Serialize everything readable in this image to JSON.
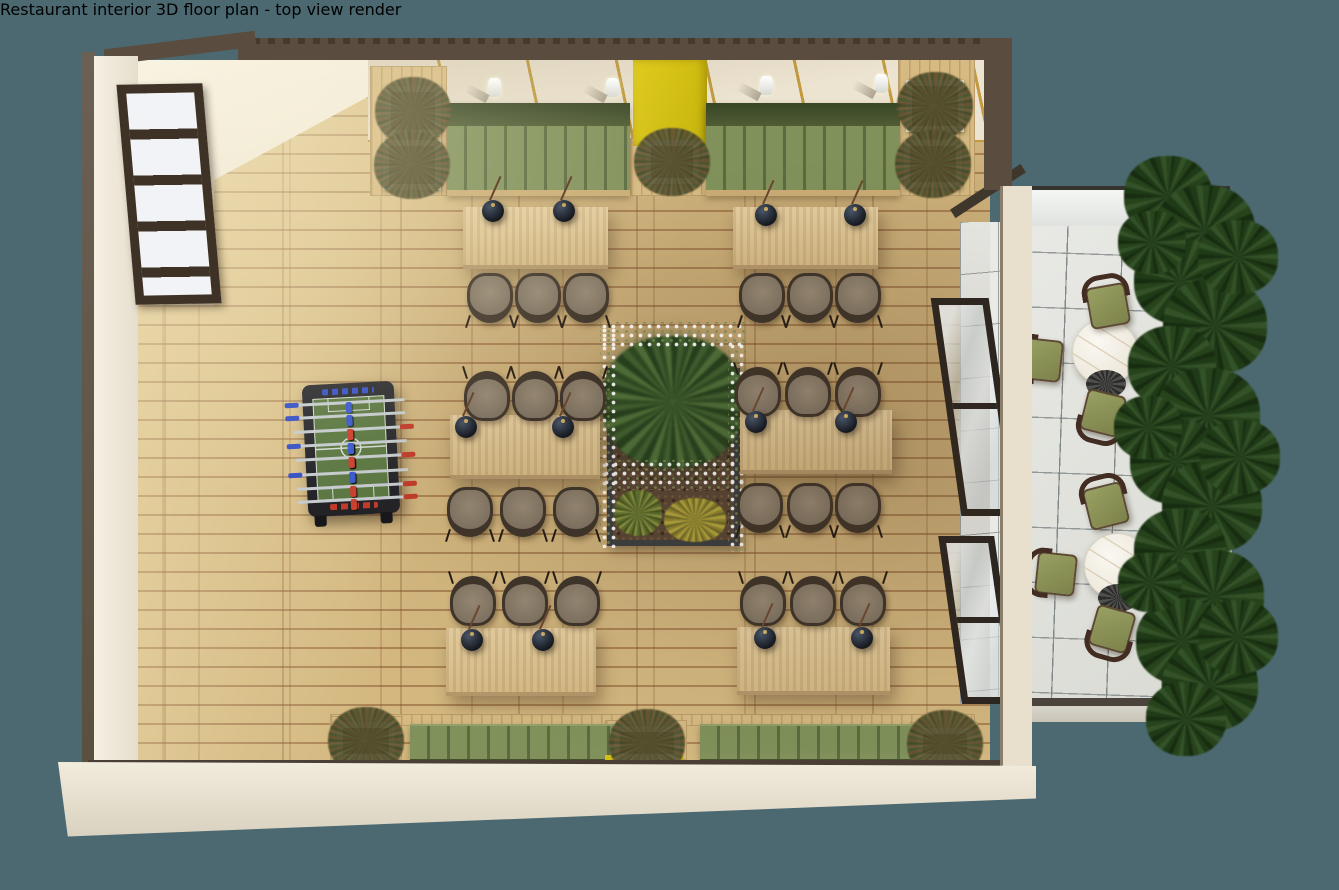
{
  "scene": {
    "title": "Restaurant interior 3D floor plan - top view render",
    "background_color": "#4c6971"
  },
  "colors": {
    "floor_wood": "#d3b77f",
    "floor_seam": "#8b542e",
    "wall_cream": "#efe8d8",
    "wall_dark": "#5a4d40",
    "accent_yellow": "#d2c017",
    "panel_gold_trim": "#c19b3e",
    "banquette_seat": "#80915b",
    "banquette_back": "#44502e",
    "table_wood": "#ddc596",
    "chair_cushion": "#8c7f6e",
    "chair_frame": "#3e342a",
    "pendant_black": "#1a1d23",
    "pendant_brass": "#c9a85f",
    "planter_white": "#f1eee6",
    "soil_brown": "#4a372a",
    "fern_green": "#3f6030",
    "flower_white": "#ffffff",
    "foosball_frame": "#26262b",
    "foosball_field": "#5c7843",
    "foosball_blue": "#3752c5",
    "foosball_red": "#c23b2a",
    "patio_tile": "#e2e3de",
    "patio_grid": "#8e9494",
    "patio_chair_olive": "#8b9156",
    "patio_chair_frame": "#432d22",
    "marble_table": "#f2efe7",
    "hedge_green": "#2c4a21"
  },
  "dining": {
    "tables": [
      {
        "x": 463,
        "y": 207,
        "w": 145,
        "h": 62
      },
      {
        "x": 733,
        "y": 207,
        "w": 145,
        "h": 62
      },
      {
        "x": 450,
        "y": 415,
        "w": 150,
        "h": 64
      },
      {
        "x": 740,
        "y": 410,
        "w": 152,
        "h": 64
      },
      {
        "x": 446,
        "y": 628,
        "w": 150,
        "h": 68
      },
      {
        "x": 737,
        "y": 627,
        "w": 153,
        "h": 68
      }
    ],
    "pendants": [
      [
        493,
        211
      ],
      [
        564,
        211
      ],
      [
        766,
        215
      ],
      [
        855,
        215
      ],
      [
        466,
        427
      ],
      [
        563,
        427
      ],
      [
        756,
        422
      ],
      [
        846,
        422
      ],
      [
        472,
        640
      ],
      [
        543,
        640
      ],
      [
        765,
        638
      ],
      [
        862,
        638
      ]
    ],
    "chairs": [
      {
        "x": 490,
        "y": 298,
        "f": "up"
      },
      {
        "x": 538,
        "y": 298,
        "f": "up"
      },
      {
        "x": 586,
        "y": 298,
        "f": "up"
      },
      {
        "x": 762,
        "y": 298,
        "f": "up"
      },
      {
        "x": 810,
        "y": 298,
        "f": "up"
      },
      {
        "x": 858,
        "y": 298,
        "f": "up"
      },
      {
        "x": 487,
        "y": 396,
        "f": "down"
      },
      {
        "x": 535,
        "y": 396,
        "f": "down"
      },
      {
        "x": 583,
        "y": 396,
        "f": "down"
      },
      {
        "x": 470,
        "y": 512,
        "f": "up"
      },
      {
        "x": 523,
        "y": 512,
        "f": "up"
      },
      {
        "x": 576,
        "y": 512,
        "f": "up"
      },
      {
        "x": 758,
        "y": 392,
        "f": "down"
      },
      {
        "x": 808,
        "y": 392,
        "f": "down"
      },
      {
        "x": 858,
        "y": 392,
        "f": "down"
      },
      {
        "x": 760,
        "y": 508,
        "f": "up"
      },
      {
        "x": 810,
        "y": 508,
        "f": "up"
      },
      {
        "x": 858,
        "y": 508,
        "f": "up"
      },
      {
        "x": 473,
        "y": 601,
        "f": "down"
      },
      {
        "x": 525,
        "y": 601,
        "f": "down"
      },
      {
        "x": 577,
        "y": 601,
        "f": "down"
      },
      {
        "x": 763,
        "y": 601,
        "f": "down"
      },
      {
        "x": 813,
        "y": 601,
        "f": "down"
      },
      {
        "x": 863,
        "y": 601,
        "f": "down"
      }
    ]
  },
  "sconces": [
    [
      495,
      88
    ],
    [
      613,
      88
    ],
    [
      767,
      86
    ],
    [
      882,
      84
    ]
  ],
  "platforms": [
    {
      "x": 370,
      "y": 66,
      "w": 77,
      "h": 130
    },
    {
      "x": 630,
      "y": 138,
      "w": 80,
      "h": 58
    },
    {
      "x": 898,
      "y": 58,
      "w": 77,
      "h": 138
    },
    {
      "x": 330,
      "y": 714,
      "w": 645,
      "h": 12
    },
    {
      "x": 330,
      "y": 716,
      "w": 72,
      "h": 44
    },
    {
      "x": 605,
      "y": 720,
      "w": 82,
      "h": 40
    },
    {
      "x": 910,
      "y": 722,
      "w": 68,
      "h": 38
    }
  ],
  "banquettes": [
    {
      "x": 447,
      "y": 103,
      "w": 183,
      "kind": "top"
    },
    {
      "x": 706,
      "y": 103,
      "w": 194,
      "kind": "top"
    },
    {
      "x": 410,
      "y": 724,
      "w": 222,
      "kind": "bottom"
    },
    {
      "x": 700,
      "y": 724,
      "w": 215,
      "kind": "bottom"
    }
  ],
  "planters": [
    {
      "x": 385,
      "y": 86,
      "w": 56,
      "h": 50
    },
    {
      "x": 383,
      "y": 140,
      "w": 58,
      "h": 50
    },
    {
      "x": 645,
      "y": 140,
      "w": 54,
      "h": 44
    },
    {
      "x": 906,
      "y": 80,
      "w": 58,
      "h": 52
    },
    {
      "x": 904,
      "y": 140,
      "w": 58,
      "h": 48
    },
    {
      "x": 337,
      "y": 722,
      "w": 58,
      "h": 38
    },
    {
      "x": 614,
      "y": 726,
      "w": 66,
      "h": 34
    },
    {
      "x": 917,
      "y": 728,
      "w": 56,
      "h": 32
    }
  ],
  "foosball": {
    "x": 305,
    "y": 383,
    "w": 92,
    "h": 132,
    "rot": -3,
    "rows": [
      {
        "y": 18,
        "c": "blue",
        "n": 1
      },
      {
        "y": 31,
        "c": "blue",
        "n": 2
      },
      {
        "y": 45,
        "c": "red",
        "n": 3
      },
      {
        "y": 59,
        "c": "blue",
        "n": 5
      },
      {
        "y": 73,
        "c": "red",
        "n": 5
      },
      {
        "y": 88,
        "c": "blue",
        "n": 3
      },
      {
        "y": 102,
        "c": "red",
        "n": 2
      },
      {
        "y": 115,
        "c": "red",
        "n": 1
      }
    ]
  },
  "patio": {
    "tables": [
      {
        "x": 1105,
        "y": 352
      },
      {
        "x": 1117,
        "y": 566
      }
    ],
    "chairs": [
      {
        "x": 1108,
        "y": 306,
        "rot": -10,
        "f": "fd"
      },
      {
        "x": 1042,
        "y": 360,
        "rot": 6,
        "f": "fr"
      },
      {
        "x": 1160,
        "y": 356,
        "rot": -6,
        "f": "fl"
      },
      {
        "x": 1103,
        "y": 413,
        "rot": 14,
        "f": "fu"
      },
      {
        "x": 1106,
        "y": 506,
        "rot": -14,
        "f": "fd"
      },
      {
        "x": 1056,
        "y": 574,
        "rot": 6,
        "f": "fr"
      },
      {
        "x": 1175,
        "y": 573,
        "rot": -8,
        "f": "fl"
      },
      {
        "x": 1112,
        "y": 629,
        "rot": 16,
        "f": "fu"
      }
    ],
    "hedge": [
      {
        "x": 1168,
        "y": 200,
        "r": 44
      },
      {
        "x": 1205,
        "y": 235,
        "r": 50
      },
      {
        "x": 1180,
        "y": 285,
        "r": 46
      },
      {
        "x": 1215,
        "y": 330,
        "r": 52
      },
      {
        "x": 1172,
        "y": 370,
        "r": 44
      },
      {
        "x": 1208,
        "y": 420,
        "r": 52
      },
      {
        "x": 1176,
        "y": 465,
        "r": 46
      },
      {
        "x": 1212,
        "y": 510,
        "r": 50
      },
      {
        "x": 1180,
        "y": 555,
        "r": 46
      },
      {
        "x": 1214,
        "y": 600,
        "r": 50
      },
      {
        "x": 1182,
        "y": 645,
        "r": 46
      },
      {
        "x": 1210,
        "y": 690,
        "r": 48
      },
      {
        "x": 1186,
        "y": 722,
        "r": 40
      },
      {
        "x": 1152,
        "y": 245,
        "r": 34
      },
      {
        "x": 1148,
        "y": 430,
        "r": 34
      },
      {
        "x": 1150,
        "y": 585,
        "r": 32
      },
      {
        "x": 1238,
        "y": 260,
        "r": 40
      },
      {
        "x": 1240,
        "y": 460,
        "r": 40
      },
      {
        "x": 1238,
        "y": 640,
        "r": 40
      }
    ]
  }
}
